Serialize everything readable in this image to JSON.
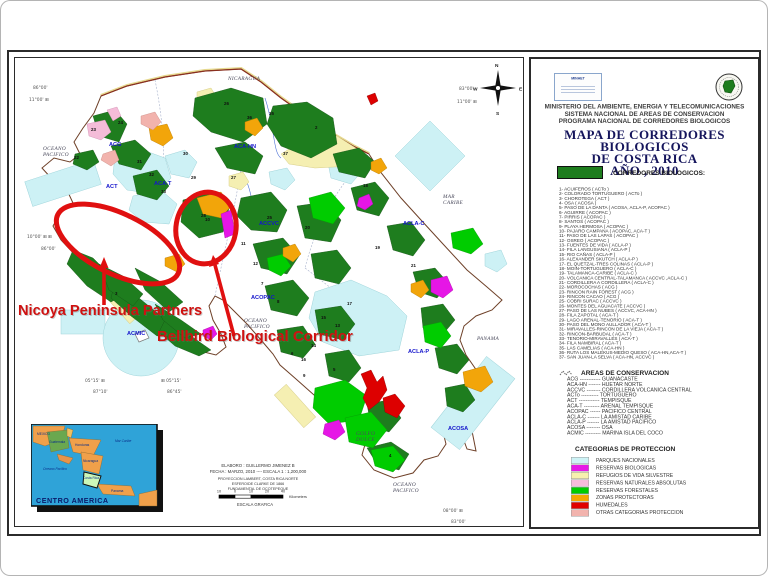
{
  "annotations": {
    "nicoya": "Nicoya Peninsula Partners",
    "bellbird": "Bellbird Biological Corridor"
  },
  "legend": {
    "logo_left_text": "MINAET",
    "org_lines": [
      "MINISTERIO DEL AMBIENTE, ENERGIA Y TELECOMUNICACIONES",
      "SISTEMA NACIONAL DE AREAS DE CONSERVACION",
      "PROGRAMA NACIONAL DE CORREDORES BIOLOGICOS"
    ],
    "title_lines": [
      "MAPA DE CORREDORES BIOLOGICOS",
      "DE COSTA RICA",
      "AÑO , 2010"
    ],
    "corridors_heading": "CORREDORES BIOLOGICOS:",
    "corridor_swatch_color": "#1e7d1e",
    "corridors": [
      "1-  ACUIFEROS ( ACTo )",
      "2-  COLORADO TORTUGUERO ( ACTo )",
      "3-  CHOROTEGA ( ACT )",
      "4-  OSA ( ACOSA )",
      "5-  PASO DE LA DANTA ( ACOSA, ACLA-P, ACOPAC )",
      "6-  AGUIRRE ( ACOPAC )",
      "7-  PIRRIS ( ACOPAC )",
      "8-  SANTOS ( ACOPAC )",
      "9-  PLAYA HERMOSA ( ACOPAC )",
      "10- PAJARO CAMPANA ( ACOPAC, ACA-T )",
      "11- PASO DE LAS LAPAS ( ACOPAC )",
      "12- OSREO ( ACOPAC )",
      "13- FUENTES DE VIDA ( ACLA-P )",
      "14- FILA LANGUSIANA ( ACLA-P )",
      "15- RIO CAÑAS ( ACLA-P )",
      "16- ALEXANDER SKUTCH ( ACLA-P )",
      "17- EL QUETZAL-TRES COLINAS ( ACLA-P )",
      "18- MOIN-TORTUGUERO ( ACLA-C )",
      "19- TALAMANCA-CARIBE ( ACLA-C )",
      "20- VOLCANICA CENTRAL-TALAMANCA ( ACCVC ,ACLA-C )",
      "21- CORDILLERA A CORDILLERA ( ACLA-C )",
      "22- MOROCOCHAS ( ACG )",
      "23- RINCON RAIN FOREST ( ACG )",
      "24- RINCON CACAO ( ACG )",
      "25- COBRI SURAC ( ACCVC )",
      "26- MONTES DEL AGUACATE ( ACCVC )",
      "27- PASO DE LAS NUBES ( ACCVC, ACA-HN )",
      "28- FILA ZAPOTAL ( ACA-T )",
      "29- LAGO ARENAL-TENORIO ( ACA-T )",
      "30- PASO DEL MONO AULLADOR ( ACA-T )",
      "31- MIRAVALLES-RINCON DE LA VIEJA ( ACA-T )",
      "32- RINCON-BARBUDAL ( ACA-T )",
      "33- TENORIO-MIRAVALLES ( ACA-T )",
      "34- FILA NAMBIRAL ( ACA-T )",
      "35- LAS CAMELIAS ( ACA-HN )",
      "36- RUTA LOS MALEKUS-MEDIO QUESO ( ACA-HN,ACA-T )",
      "37- SAN JUAN-LA SELVA ( ACA-HN, ACCVC )"
    ],
    "areas_heading": "AREAS DE CONSERVACION",
    "areas": [
      "ACG ------------ GUANACASTE",
      "ACA-HN ------- HUETAR NORTE",
      "ACCVC -------- CORDILLERA VOLCANICA CENTRAL",
      "ACTo ---------- TORTUGUERO",
      "ACT ------------ TEMPISQUE",
      "ACA-T --------- ARENAL TEMPISQUE",
      "ACOPAC ------ PACIFICO CENTRAL",
      "ACLA-C ------- LA AMISTAD CARIBE",
      "ACLA-P ------- LA AMISTAD PACIFICO",
      "ACOSA -------- OSA",
      "ACMIC --------- MARINA ISLA DEL COCO"
    ],
    "categories_heading": "CATEGORIAS DE PROTECCION",
    "categories": [
      {
        "label": "PARQUES NACIONALES",
        "color": "#cdf3f6"
      },
      {
        "label": "RESERVAS BIOLOGICAS",
        "color": "#e61ae6"
      },
      {
        "label": "REFUGIOS DE VIDA SILVESTRE",
        "color": "#f7f0ae"
      },
      {
        "label": "RESERVAS NATURALES ABSOLUTAS",
        "color": "#f6bcda"
      },
      {
        "label": "RESERVAS FORESTALES",
        "color": "#00cc00"
      },
      {
        "label": "ZONAS PROTECTORAS",
        "color": "#f5a800"
      },
      {
        "label": "HUMEDALES",
        "color": "#e00000"
      },
      {
        "label": "OTRAS CATEGORIAS PROTECCION",
        "color": "#f2b3ad"
      }
    ]
  },
  "map": {
    "sea_labels": [
      {
        "lines": [
          "NICARAGUA"
        ],
        "x": 213,
        "y": 22
      },
      {
        "lines": [
          "OCEANO",
          "PACIFICO"
        ],
        "x": 28,
        "y": 92
      },
      {
        "lines": [
          "MAR",
          "CARIBE"
        ],
        "x": 428,
        "y": 140
      },
      {
        "lines": [
          "OCEANO",
          "PACIFICO"
        ],
        "x": 229,
        "y": 264
      },
      {
        "lines": [
          "PANAMA"
        ],
        "x": 462,
        "y": 282
      },
      {
        "lines": [
          "GOLFO",
          "DULCE"
        ],
        "x": 341,
        "y": 377
      },
      {
        "lines": [
          "OCEANO",
          "PACIFICO"
        ],
        "x": 378,
        "y": 428
      }
    ],
    "region_labels": [
      {
        "text": "ACG",
        "x": 94,
        "y": 88
      },
      {
        "text": "ACT",
        "x": 91,
        "y": 130
      },
      {
        "text": "ACA-T",
        "x": 139,
        "y": 127
      },
      {
        "text": "ACA-HN",
        "x": 219,
        "y": 90
      },
      {
        "text": "ACCVC",
        "x": 244,
        "y": 167
      },
      {
        "text": "ACOPAC",
        "x": 236,
        "y": 241
      },
      {
        "text": "ACLA-C",
        "x": 388,
        "y": 167
      },
      {
        "text": "ACLA-P",
        "x": 393,
        "y": 295
      },
      {
        "text": "ACOSA",
        "x": 433,
        "y": 372
      },
      {
        "text": "ACMIC",
        "x": 112,
        "y": 277
      }
    ],
    "numbers": [
      {
        "n": "24",
        "x": 103,
        "y": 66
      },
      {
        "n": "23",
        "x": 76,
        "y": 73
      },
      {
        "n": "22",
        "x": 59,
        "y": 101
      },
      {
        "n": "30",
        "x": 168,
        "y": 97
      },
      {
        "n": "31",
        "x": 122,
        "y": 105
      },
      {
        "n": "32",
        "x": 134,
        "y": 118
      },
      {
        "n": "33",
        "x": 146,
        "y": 135
      },
      {
        "n": "29",
        "x": 176,
        "y": 121
      },
      {
        "n": "26",
        "x": 209,
        "y": 47
      },
      {
        "n": "35",
        "x": 254,
        "y": 57
      },
      {
        "n": "36",
        "x": 232,
        "y": 61
      },
      {
        "n": "2",
        "x": 300,
        "y": 71
      },
      {
        "n": "37",
        "x": 268,
        "y": 97
      },
      {
        "n": "27",
        "x": 216,
        "y": 121
      },
      {
        "n": "28",
        "x": 186,
        "y": 159
      },
      {
        "n": "10",
        "x": 190,
        "y": 163
      },
      {
        "n": "25",
        "x": 252,
        "y": 161
      },
      {
        "n": "20",
        "x": 290,
        "y": 171
      },
      {
        "n": "18",
        "x": 348,
        "y": 129
      },
      {
        "n": "19",
        "x": 360,
        "y": 191
      },
      {
        "n": "3",
        "x": 100,
        "y": 237
      },
      {
        "n": "11",
        "x": 226,
        "y": 187
      },
      {
        "n": "12",
        "x": 238,
        "y": 207
      },
      {
        "n": "7",
        "x": 246,
        "y": 227
      },
      {
        "n": "8",
        "x": 262,
        "y": 245
      },
      {
        "n": "6",
        "x": 276,
        "y": 297
      },
      {
        "n": "9",
        "x": 288,
        "y": 319
      },
      {
        "n": "13",
        "x": 320,
        "y": 269
      },
      {
        "n": "17",
        "x": 332,
        "y": 247
      },
      {
        "n": "14",
        "x": 296,
        "y": 289
      },
      {
        "n": "16",
        "x": 286,
        "y": 303
      },
      {
        "n": "5",
        "x": 318,
        "y": 313
      },
      {
        "n": "15",
        "x": 306,
        "y": 261
      },
      {
        "n": "21",
        "x": 396,
        "y": 209
      },
      {
        "n": "4",
        "x": 374,
        "y": 399
      }
    ],
    "coords": [
      {
        "text": "86°00'",
        "x": 18,
        "y": 31
      },
      {
        "text": "11°00'  ⊞",
        "x": 14,
        "y": 43
      },
      {
        "text": "83°00'",
        "x": 444,
        "y": 32
      },
      {
        "text": "11°00'  ⊞",
        "x": 442,
        "y": 45
      },
      {
        "text": "10°00'  ⊞ ⊞",
        "x": 12,
        "y": 180
      },
      {
        "text": "86°00'",
        "x": 26,
        "y": 192
      },
      {
        "text": "05°15' ⊞",
        "x": 70,
        "y": 324
      },
      {
        "text": "87°10'",
        "x": 78,
        "y": 335
      },
      {
        "text": "⊞ 05°15'",
        "x": 146,
        "y": 324
      },
      {
        "text": "86°45'",
        "x": 152,
        "y": 335
      },
      {
        "text": "08°00' ⊞",
        "x": 428,
        "y": 454
      },
      {
        "text": "83°00'",
        "x": 436,
        "y": 465
      }
    ],
    "compass": {
      "n": "N",
      "s": "S",
      "e": "E",
      "w": "W"
    },
    "credits": [
      "ELABORO : GUILLERMO JIMENEZ B",
      "FECHA : MARZO, 2010 ---- ESCALA 1 : 1,200,000",
      "PROYECCION LAMBERT, COSTA RICA NORTE",
      "ESFEROIDE CLARKE DE 1866",
      "FUNDAMENTAL DE OCOTEPEQUE"
    ],
    "scale_ticks": [
      "10",
      "0",
      "10",
      "20",
      "40"
    ],
    "scale_units": "Kilometers",
    "scale_caption": "ESCALA GRAFICA"
  },
  "inset": {
    "title": "CENTRO AMERICA",
    "labels": [
      {
        "text": "MEXICO",
        "x": 6,
        "y": 11
      },
      {
        "text": "Guatemala",
        "x": 18,
        "y": 19
      },
      {
        "text": "Honduras",
        "x": 44,
        "y": 22
      },
      {
        "text": "Nicaragua",
        "x": 52,
        "y": 38
      },
      {
        "text": "Costa Rica",
        "x": 52,
        "y": 55
      },
      {
        "text": "Panama",
        "x": 80,
        "y": 68
      },
      {
        "text": "Mar Caribe",
        "x": 84,
        "y": 18
      },
      {
        "text": "Oceano Pacifico",
        "x": 12,
        "y": 46
      }
    ]
  },
  "palette": {
    "corridor_green": "#1e7d1e",
    "forest_green": "#00cc00",
    "park_cyan": "#cdf1f5",
    "biologica_magenta": "#e616e6",
    "refugio_yellow": "#f5efb2",
    "zona_orange": "#f2a50a",
    "humedal_red": "#dd0000",
    "annotation_red": "#cf1110",
    "region_label_blue": "#1515cc",
    "inset_sea_blue": "#2fa3d8"
  }
}
